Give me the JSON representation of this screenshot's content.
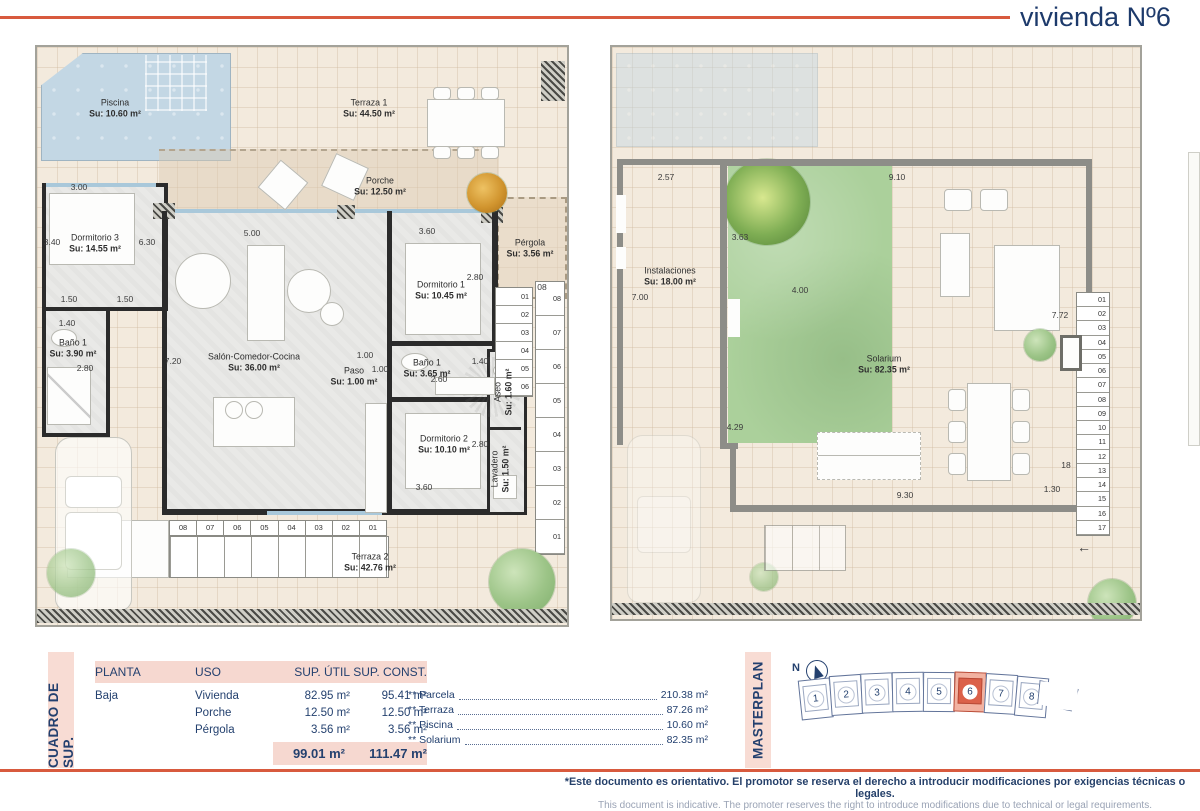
{
  "header": {
    "title": "vivienda Nº6"
  },
  "colors": {
    "accent": "#d85a3e",
    "navy": "#1e3a6e",
    "pink": "#f8dcd4",
    "pool": "#c3d7e4",
    "garden": "#abd09b",
    "highlight_plot": "#db614a"
  },
  "left_plan": {
    "rooms": [
      {
        "name": "Piscina",
        "area": "Su: 10.60 m²"
      },
      {
        "name": "Terraza 1",
        "area": "Su: 44.50 m²"
      },
      {
        "name": "Porche",
        "area": "Su: 12.50 m²"
      },
      {
        "name": "Dormitorio 3",
        "area": "Su: 14.55 m²"
      },
      {
        "name": "Baño 1",
        "area": "Su: 3.90 m²"
      },
      {
        "name": "Salón-Comedor-Cocina",
        "area": "Su: 36.00 m²"
      },
      {
        "name": "Paso",
        "area": "Su: 1.00 m²"
      },
      {
        "name": "Baño 1",
        "area": "Su: 3.65 m²"
      },
      {
        "name": "Dormitorio 1",
        "area": "Su: 10.45 m²"
      },
      {
        "name": "Dormitorio 2",
        "area": "Su: 10.10 m²"
      },
      {
        "name": "Aseo",
        "area": "Su: 1.60 m²"
      },
      {
        "name": "Lavadero",
        "area": "Su: 1.50 m²"
      },
      {
        "name": "Pérgola",
        "area": "Su: 3.56 m²"
      },
      {
        "name": "Terraza 2",
        "area": "Su: 42.76 m²"
      }
    ],
    "dims": [
      "3.00",
      "3.40",
      "6.30",
      "5.00",
      "3.60",
      "2.80",
      "1.50",
      "1.50",
      "1.40",
      "7.20",
      "2.80",
      "1.00",
      "1.00",
      "2.60",
      "1.40",
      "2.80",
      "3.60",
      "08"
    ],
    "stairs_bottom": [
      "08",
      "07",
      "06",
      "05",
      "04",
      "03",
      "02",
      "01"
    ],
    "stairs_inner": [
      "01",
      "02",
      "03",
      "04",
      "05",
      "06"
    ],
    "stairs_outer": [
      "08",
      "07",
      "06",
      "05",
      "04",
      "03",
      "02",
      "01"
    ]
  },
  "right_plan": {
    "rooms": [
      {
        "name": "Instalaciones",
        "area": "Su: 18.00 m²"
      },
      {
        "name": "Solarium",
        "area": "Su: 82.35 m²"
      }
    ],
    "dims": [
      "2.57",
      "9.10",
      "3.63",
      "7.00",
      "4.00",
      "7.72",
      "4.29",
      "9.30",
      "18",
      "1.30"
    ],
    "stairs": [
      "01",
      "02",
      "03",
      "04",
      "05",
      "06",
      "07",
      "08",
      "09",
      "10",
      "11",
      "12",
      "13",
      "14",
      "15",
      "16",
      "17"
    ],
    "arrow": "←"
  },
  "summary": {
    "section_label": "CUADRO DE SUP.",
    "headers": [
      "PLANTA",
      "USO",
      "SUP. ÚTIL",
      "SUP. CONST."
    ],
    "rows": [
      {
        "planta": "Baja",
        "uso": "Vivienda",
        "util": "82.95 m²",
        "const": "95.41 m²"
      },
      {
        "planta": "",
        "uso": "Porche",
        "util": "12.50 m²",
        "const": "12.50 m²"
      },
      {
        "planta": "",
        "uso": "Pérgola",
        "util": "3.56 m²",
        "const": "3.56 m²"
      }
    ],
    "total_util": "99.01 m²",
    "total_const": "111.47 m²",
    "notes": [
      {
        "label": "** Parcela",
        "value": "210.38 m²"
      },
      {
        "label": "** Terraza",
        "value": "87.26 m²"
      },
      {
        "label": "** Piscina",
        "value": "10.60 m²"
      },
      {
        "label": "** Solarium",
        "value": "82.35 m²"
      }
    ]
  },
  "masterplan": {
    "section_label": "MASTERPLAN",
    "north_label": "N",
    "plots": [
      "1",
      "2",
      "3",
      "4",
      "5",
      "6",
      "7",
      "8"
    ],
    "highlighted_plot": "6"
  },
  "footer": {
    "disclaimer_es": "*Este documento es orientativo. El promotor se reserva el derecho a introducir modificaciones por exigencias técnicas o legales.",
    "disclaimer_en": "This document is indicative. The promoter reserves the right to introduce modifications due to technical or legal requirements."
  }
}
